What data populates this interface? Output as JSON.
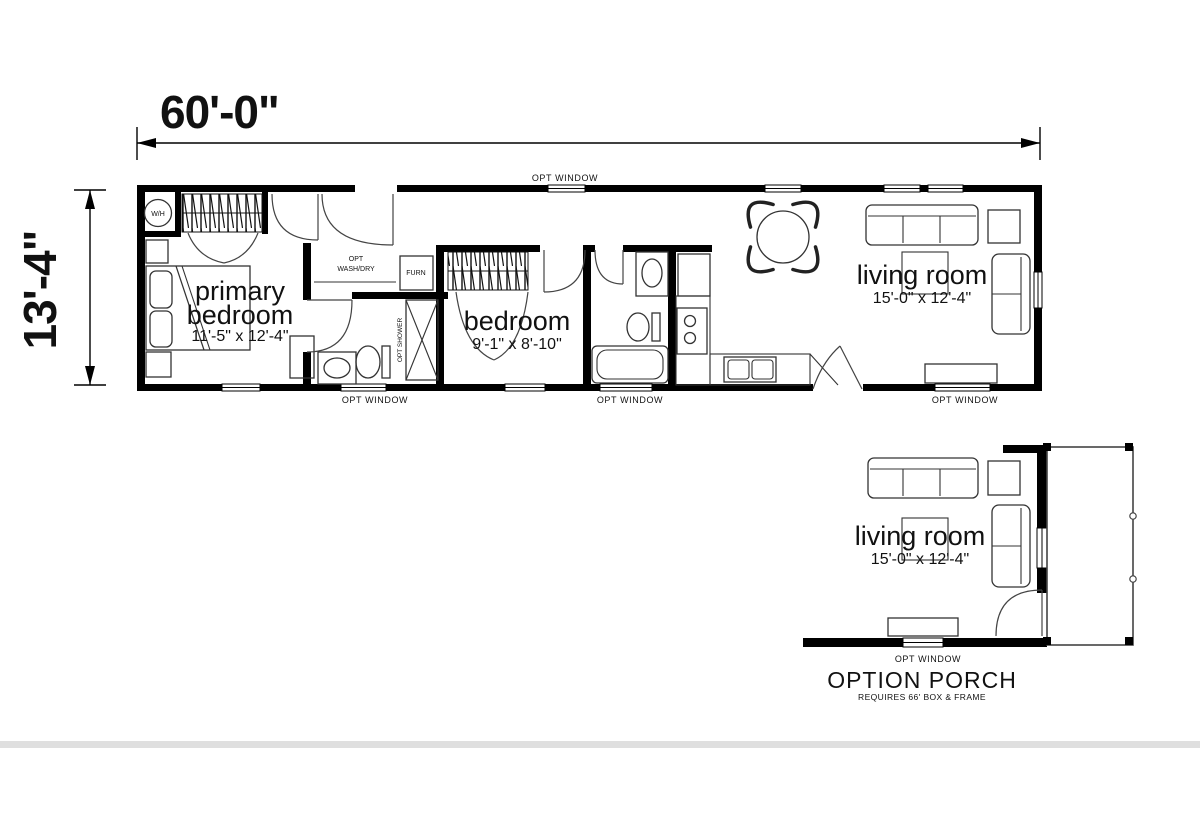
{
  "dimensions": {
    "width": "60'-0\"",
    "height": "13'-4\""
  },
  "labels": {
    "opt_window": "OPT WINDOW",
    "wash_dry_line1": "OPT",
    "wash_dry_line2": "WASH/DRY",
    "furnace": "FURN",
    "opt_shower": "OPT SHOWER",
    "water_heater": "W/H"
  },
  "rooms": {
    "primary_bedroom": {
      "line1": "primary",
      "line2": "bedroom",
      "dims": "11'-5\" x 12'-4\""
    },
    "bedroom": {
      "name": "bedroom",
      "dims": "9'-1\" x 8'-10\""
    },
    "living_room": {
      "name": "living room",
      "dims": "15'-0\" x 12'-4\""
    }
  },
  "porch_option": {
    "living_room_name": "living room",
    "living_room_dims": "15'-0\" x 12'-4\"",
    "opt_window": "OPT WINDOW",
    "title": "OPTION PORCH",
    "subtitle": "REQUIRES 66' BOX & FRAME"
  }
}
